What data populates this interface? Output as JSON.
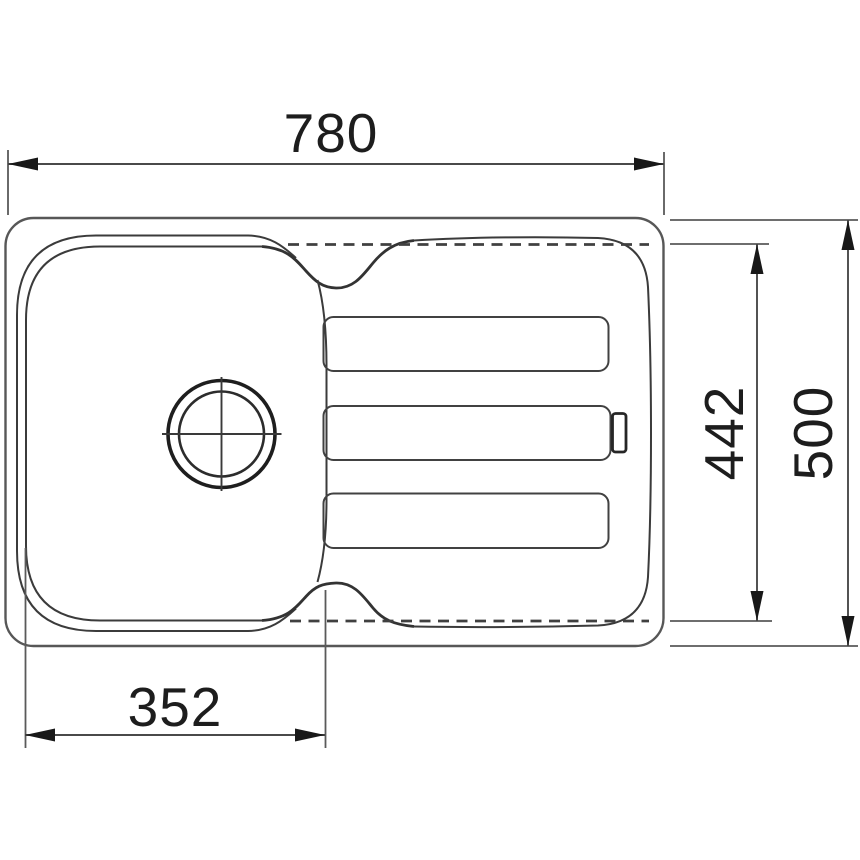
{
  "diagram": {
    "type": "technical-drawing",
    "subject": "kitchen-sink-top-view-with-drainer",
    "units_implied": "mm",
    "dimensions": {
      "overall_width": {
        "value": "780",
        "location": "top"
      },
      "inner_depth": {
        "value": "442",
        "location": "right-inner"
      },
      "overall_depth": {
        "value": "500",
        "location": "right-outer"
      },
      "bowl_inner_width": {
        "value": "352",
        "location": "bottom-left"
      }
    },
    "features": {
      "bowl": "single bowl left with rounded corners and drain crosshair",
      "drainer": "right drainboard with three ribs and small overflow tab",
      "hidden_edges": "dashed lines marking inner depth extent"
    },
    "colors": {
      "background": "#ffffff",
      "drawing_line": "#3b3b3b",
      "outline_line": "#575757",
      "dimension_line": "#4a4a4a",
      "text": "#1d1d1d"
    }
  }
}
